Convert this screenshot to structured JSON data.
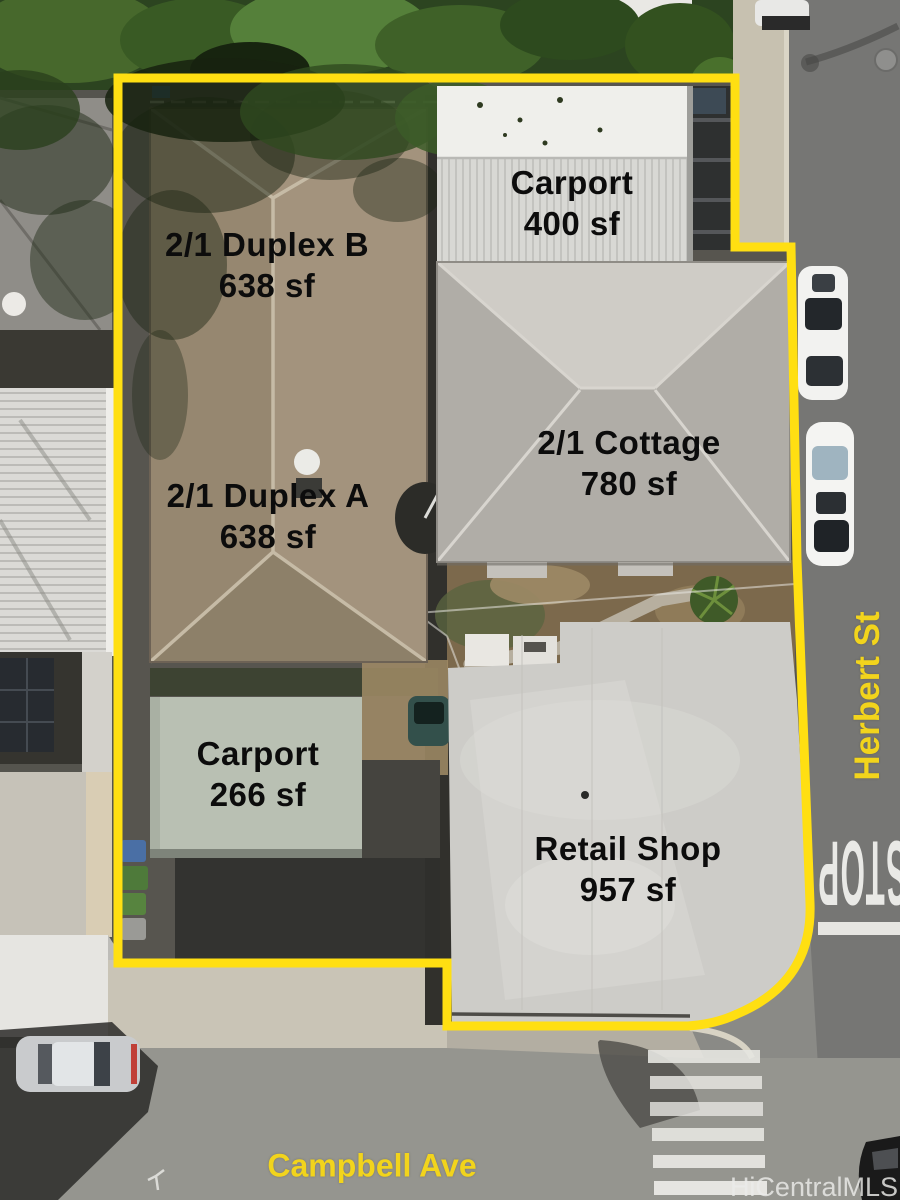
{
  "image": {
    "description": "aerial drone photo of a multi-unit property outlined in yellow"
  },
  "parcel": {
    "outline_color": "#FFDF12",
    "labels": {
      "duplex_b": {
        "name": "2/1 Duplex B",
        "area": "638 sf"
      },
      "carport_top": {
        "name": "Carport",
        "area": "400 sf"
      },
      "cottage": {
        "name": "2/1 Cottage",
        "area": "780 sf"
      },
      "duplex_a": {
        "name": "2/1 Duplex A",
        "area": "638 sf"
      },
      "carport_bottom": {
        "name": "Carport",
        "area": "266 sf"
      },
      "retail": {
        "name": "Retail Shop",
        "area": "957 sf"
      }
    }
  },
  "streets": {
    "right": "Herbert St",
    "bottom": "Campbell Ave"
  },
  "road_markings": {
    "stop": "STOP"
  },
  "watermark": "HiCentralMLS",
  "colors": {
    "boundary_yellow": "#FFDF12",
    "street_label_yellow": "#f2d41c",
    "label_text": "#0c0c0c",
    "asphalt_right_road": "#767674",
    "asphalt_bottom_road": "#95958f"
  }
}
